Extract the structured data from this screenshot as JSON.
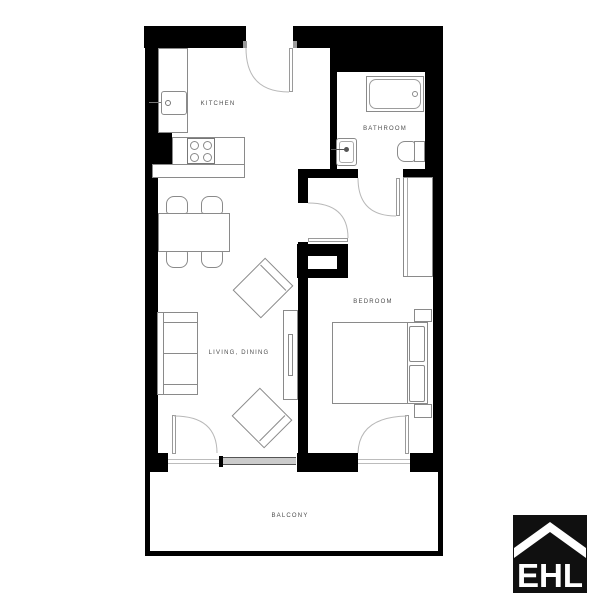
{
  "rooms": {
    "kitchen": {
      "label": "KITCHEN"
    },
    "bathroom": {
      "label": "BATHROOM"
    },
    "bedroom": {
      "label": "BEDROOM"
    },
    "living_dining": {
      "label": "LIVING, DINING"
    },
    "balcony": {
      "label": "BALCONY"
    }
  },
  "logo": {
    "text": "EHL"
  },
  "colors": {
    "wall": "#000000",
    "furniture-line": "#8a8a8a",
    "door-line": "#9a9a9a",
    "arc": "#b8b8b8",
    "label": "#4d4d4d",
    "window-fill": "#cbcbcb",
    "window-line": "#555555",
    "logo-bg": "#101010",
    "logo-fg": "#ffffff"
  }
}
